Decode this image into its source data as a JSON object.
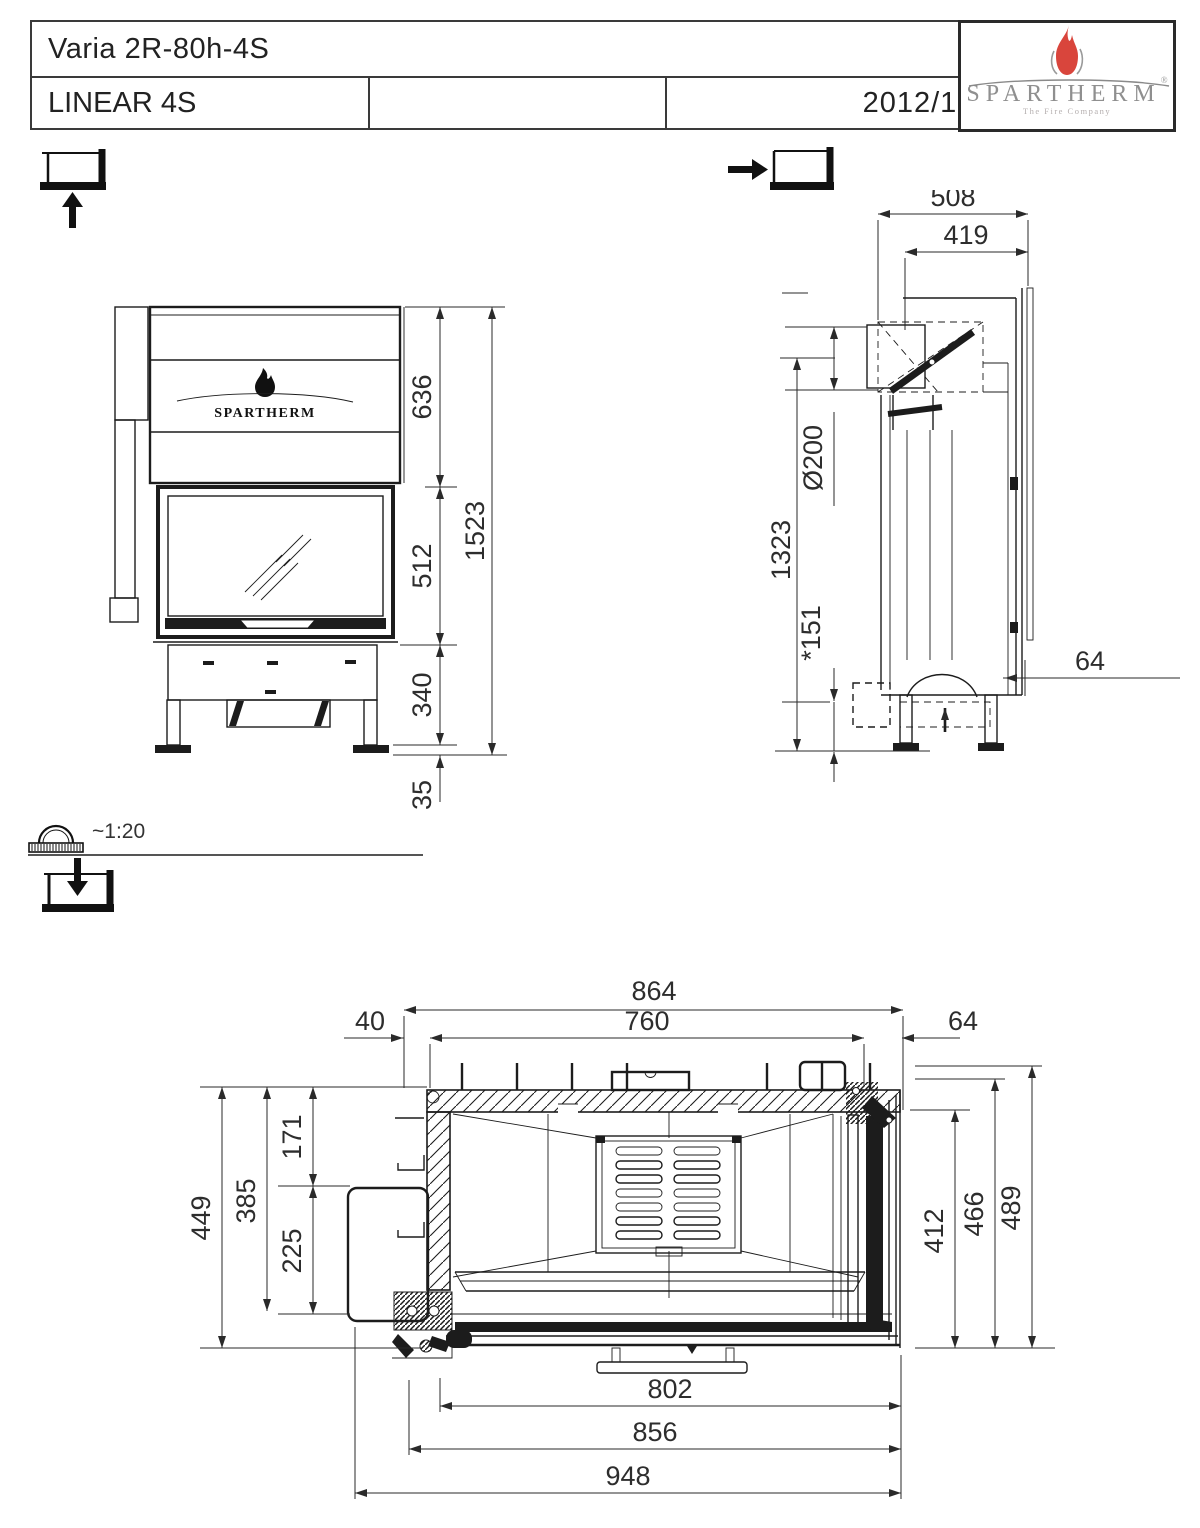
{
  "title_block": {
    "product_name": "Varia 2R-80h-4S",
    "series": "LINEAR 4S",
    "date": "2012/12",
    "brand": {
      "name": "SPARTHERM",
      "registered": "®",
      "tagline": "The Fire Company"
    }
  },
  "view_scale": "~1:20",
  "front_view": {
    "logo_text": "SPARTHERM",
    "dims": {
      "upper_section_height": "636",
      "glass_height": "512",
      "base_height": "340",
      "feet_height": "35",
      "total_height": "1523"
    }
  },
  "side_view": {
    "dims": {
      "total_depth": "508",
      "flue_offset": "419",
      "flue_diameter": "Ø200",
      "flue_axis_height": "1323",
      "air_inlet_height": "*151",
      "rear_clearance": "64"
    }
  },
  "top_view": {
    "dims": {
      "body_width": "864",
      "inner_width": "760",
      "left_offset": "40",
      "right_offset": "64",
      "left_depth_total": "449",
      "left_depth": "385",
      "upper_depth": "171",
      "door_depth": "225",
      "interior_depth": "412",
      "back_depth": "466",
      "total_depth": "489",
      "glass_width": "802",
      "frame_width": "856",
      "total_width": "948"
    }
  },
  "colors": {
    "line": "#1c1c1c",
    "dim_text": "#2d2d2d",
    "flame_red": "#d9453c",
    "brand_gray": "#8f8f8f"
  }
}
